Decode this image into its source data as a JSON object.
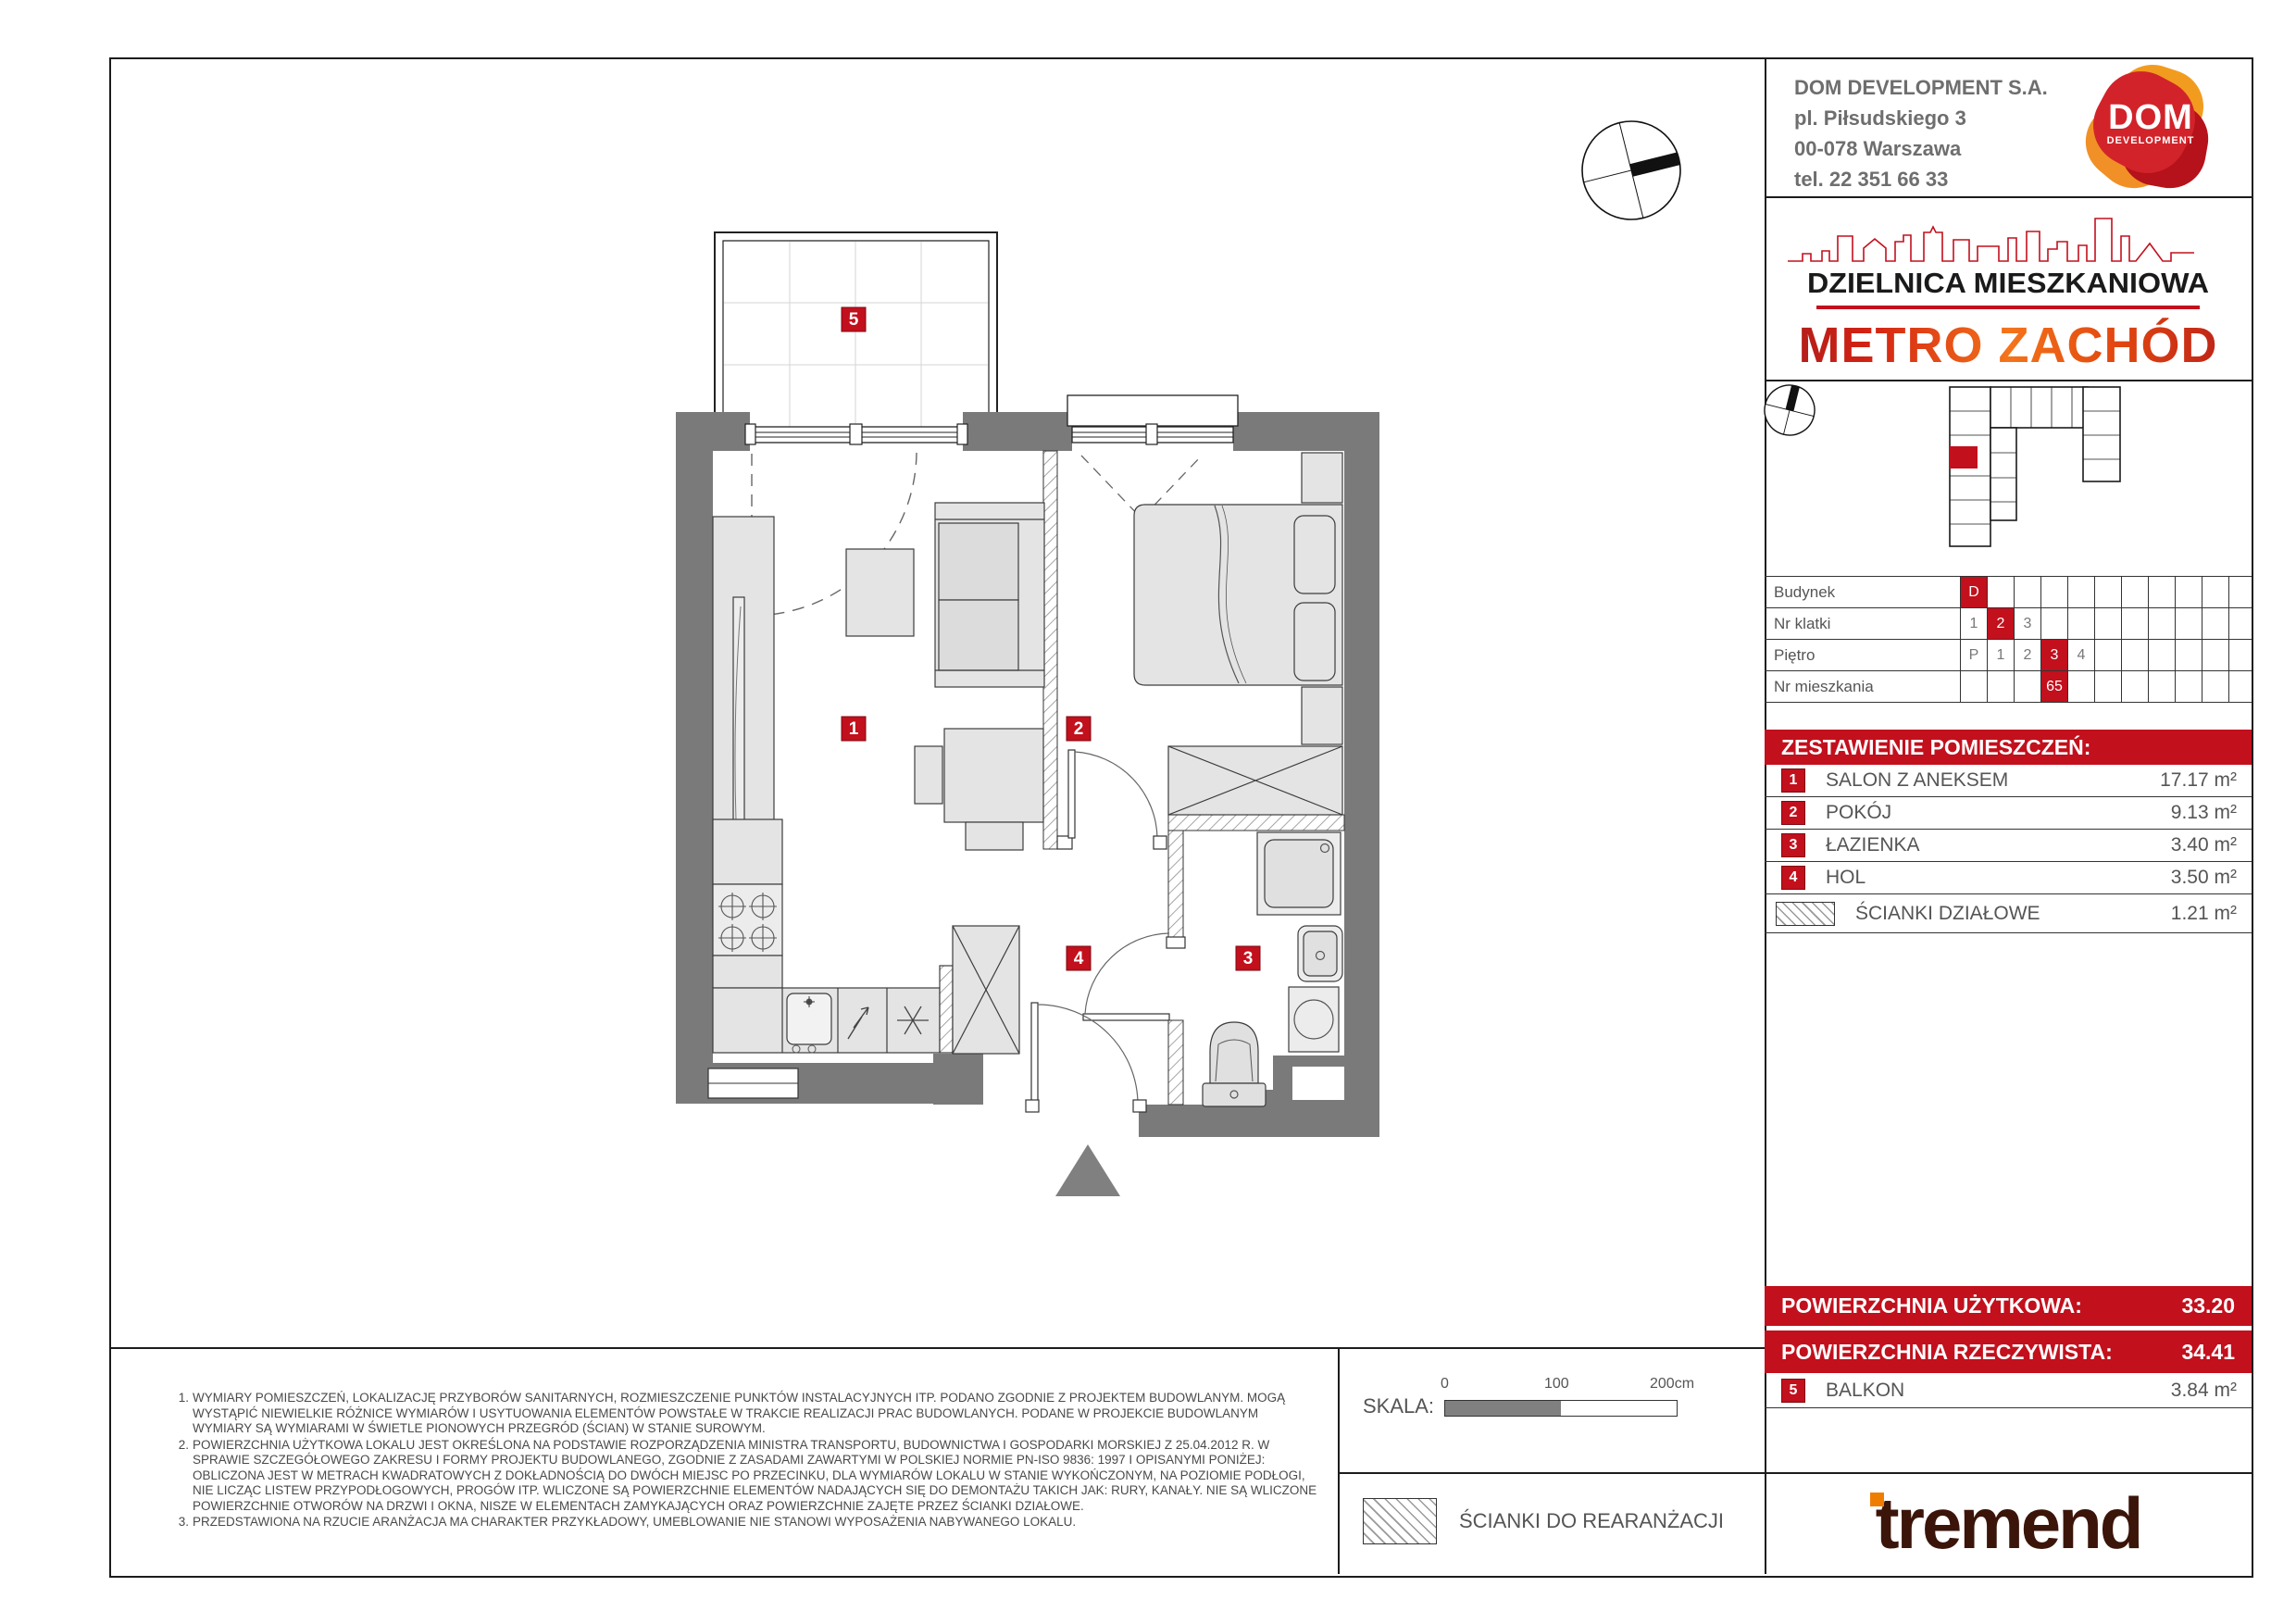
{
  "header": {
    "company_lines": [
      "DOM DEVELOPMENT S.A.",
      "pl. Piłsudskiego 3",
      "00-078 Warszawa",
      "tel. 22 351 66 33"
    ],
    "logo": {
      "line1": "DOM",
      "line2": "DEVELOPMENT"
    }
  },
  "brand": {
    "district": "DZIELNICA MIESZKANIOWA",
    "project": "METRO ZACHÓD"
  },
  "unit_table": {
    "rows": [
      {
        "label": "Budynek",
        "cells": [
          {
            "t": "D",
            "hl": true
          },
          {
            "t": ""
          },
          {
            "t": ""
          },
          {
            "t": ""
          },
          {
            "t": ""
          },
          {
            "t": ""
          },
          {
            "t": ""
          },
          {
            "t": ""
          },
          {
            "t": ""
          },
          {
            "t": ""
          }
        ]
      },
      {
        "label": "Nr klatki",
        "cells": [
          {
            "t": "1"
          },
          {
            "t": "2",
            "hl": true
          },
          {
            "t": "3"
          },
          {
            "t": ""
          },
          {
            "t": ""
          },
          {
            "t": ""
          },
          {
            "t": ""
          },
          {
            "t": ""
          },
          {
            "t": ""
          },
          {
            "t": ""
          }
        ]
      },
      {
        "label": "Piętro",
        "cells": [
          {
            "t": "P"
          },
          {
            "t": "1"
          },
          {
            "t": "2"
          },
          {
            "t": "3",
            "hl": true
          },
          {
            "t": "4"
          },
          {
            "t": ""
          },
          {
            "t": ""
          },
          {
            "t": ""
          },
          {
            "t": ""
          },
          {
            "t": ""
          }
        ]
      },
      {
        "label": "Nr mieszkania",
        "cells": [
          {
            "t": ""
          },
          {
            "t": ""
          },
          {
            "t": ""
          },
          {
            "t": "65",
            "hl": true
          },
          {
            "t": ""
          },
          {
            "t": ""
          },
          {
            "t": ""
          },
          {
            "t": ""
          },
          {
            "t": ""
          },
          {
            "t": ""
          }
        ]
      }
    ]
  },
  "rooms": {
    "header": "ZESTAWIENIE POMIESZCZEŃ:",
    "items": [
      {
        "no": "1",
        "name": "SALON Z ANEKSEM",
        "area": "17.17 m²"
      },
      {
        "no": "2",
        "name": "POKÓJ",
        "area": "9.13 m²"
      },
      {
        "no": "3",
        "name": "ŁAZIENKA",
        "area": "3.40 m²"
      },
      {
        "no": "4",
        "name": "HOL",
        "area": "3.50 m²"
      }
    ],
    "partition_row": {
      "name": "ŚCIANKI DZIAŁOWE",
      "area": "1.21 m²"
    }
  },
  "totals": {
    "usable_label": "POWIERZCHNIA UŻYTKOWA:",
    "usable_value": "33.20",
    "real_label": "POWIERZCHNIA RZECZYWISTA:",
    "real_value": "34.41"
  },
  "balcony_row": {
    "no": "5",
    "name": "BALKON",
    "area": "3.84 m²"
  },
  "plan": {
    "labels": [
      "1",
      "2",
      "3",
      "4",
      "5"
    ]
  },
  "scale": {
    "label": "SKALA:",
    "t0": "0",
    "t100": "100",
    "t200": "200cm"
  },
  "legend": {
    "text": "ŚCIANKI DO REARANŻACJI"
  },
  "footnotes": [
    {
      "num": "1.",
      "text": "WYMIARY POMIESZCZEŃ, LOKALIZACJĘ PRZYBORÓW SANITARNYCH, ROZMIESZCZENIE PUNKTÓW INSTALACYJNYCH ITP. PODANO ZGODNIE Z PROJEKTEM BUDOWLANYM. MOGĄ WYSTĄPIĆ NIEWIELKIE RÓŻNICE WYMIARÓW I USYTUOWANIA ELEMENTÓW POWSTAŁE W TRAKCIE REALIZACJI PRAC BUDOWLANYCH. PODANE W PROJEKCIE BUDOWLANYM WYMIARY SĄ WYMIARAMI W ŚWIETLE PIONOWYCH PRZEGRÓD (ŚCIAN) W STANIE SUROWYM."
    },
    {
      "num": "2.",
      "text": "POWIERZCHNIA UŻYTKOWA LOKALU JEST OKREŚLONA NA PODSTAWIE ROZPORZĄDZENIA MINISTRA TRANSPORTU, BUDOWNICTWA I GOSPODARKI MORSKIEJ Z 25.04.2012 R. W SPRAWIE SZCZEGÓŁOWEGO ZAKRESU I FORMY PROJEKTU BUDOWLANEGO, ZGODNIE Z ZASADAMI ZAWARTYMI W POLSKIEJ NORMIE PN-ISO 9836: 1997 I OPISANYMI PONIŻEJ: OBLICZONA JEST W METRACH KWADRATOWYCH Z DOKŁADNOŚCIĄ DO DWÓCH MIEJSC PO PRZECINKU, DLA WYMIARÓW LOKALU W STANIE WYKOŃCZONYM, NA POZIOMIE PODŁOGI, NIE LICZĄC LISTEW PRZYPODŁOGOWYCH, PROGÓW ITP. WLICZONE SĄ POWIERZCHNIE ELEMENTÓW NADAJĄCYCH SIĘ DO DEMONTAŻU TAKICH JAK: RURY, KANAŁY. NIE SĄ WLICZONE POWIERZCHNIE OTWORÓW NA DRZWI I OKNA, NISZE W ELEMENTACH ZAMYKAJĄCYCH ORAZ POWIERZCHNIE ZAJĘTE PRZEZ ŚCIANKI DZIAŁOWE."
    },
    {
      "num": "3.",
      "text": "PRZEDSTAWIONA NA RZUCIE ARANŻACJA MA CHARAKTER PRZYKŁADOWY, UMEBLOWANIE NIE STANOWI WYPOSAŻENIA NABYWANEGO LOKALU."
    }
  ],
  "tremend": {
    "wordmark": "tremend"
  },
  "colors": {
    "red": "#c2101d",
    "orange": "#ef7d00",
    "wall": "#7a7a7a"
  }
}
